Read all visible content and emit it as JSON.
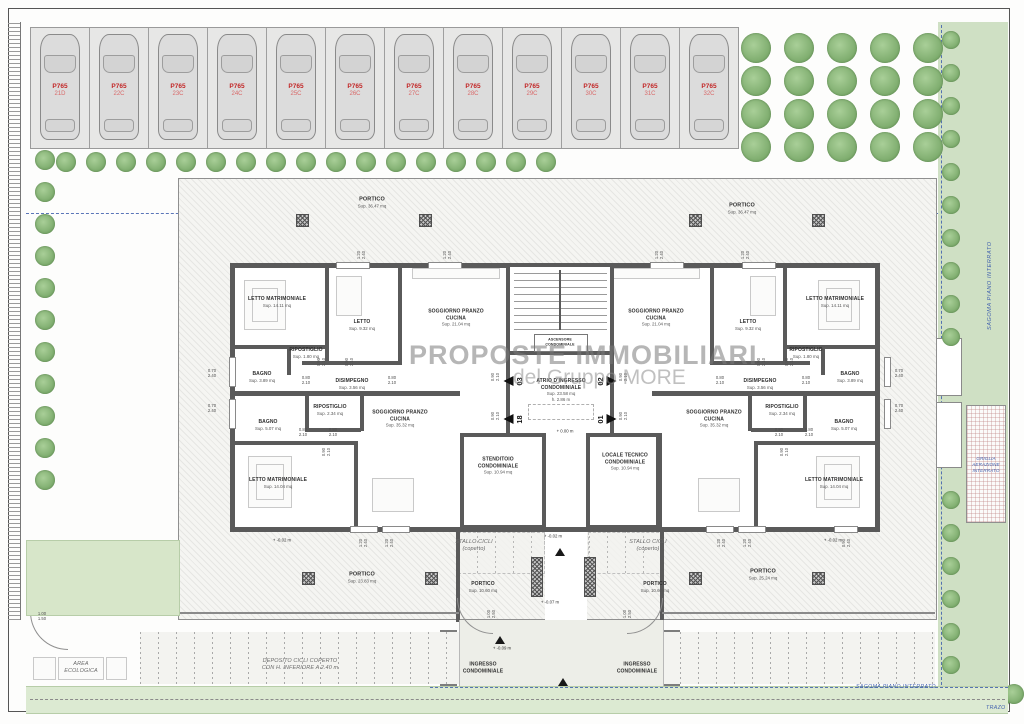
{
  "watermark": {
    "line1": "PROPOSTE IMMOBILIARI",
    "line2": "del Gruppo MORE"
  },
  "parking": {
    "code": "P765",
    "stalls": [
      "21D",
      "22C",
      "23C",
      "24C",
      "25C",
      "26C",
      "27C",
      "28C",
      "29C",
      "30C",
      "31C",
      "32C"
    ]
  },
  "site_labels": {
    "sagoma_right": "SAGOMA PIANO INTERRATO",
    "sagoma_bottom": "SAGOMA PIANO INTERRATO",
    "griglia": "GRIGLIA\nAERAZIONE\nINTERRATO",
    "trazo": "TRAZO"
  },
  "rooms": [
    {
      "n": "PORTICO",
      "s": "Sup. 36.47 mq",
      "x": 372,
      "y": 203,
      "st": "bigp"
    },
    {
      "n": "PORTICO",
      "s": "Sup. 36.47 mq",
      "x": 742,
      "y": 209,
      "st": "bigp"
    },
    {
      "n": "LETTO MATRIMONIALE",
      "s": "Sup. 14.11 mq",
      "x": 277,
      "y": 302
    },
    {
      "n": "LETTO",
      "s": "Sup. 9.32 mq",
      "x": 362,
      "y": 325
    },
    {
      "n": "SOGGIORNO PRANZO\nCUCINA",
      "s": "Sup. 21.04 mq",
      "x": 456,
      "y": 318
    },
    {
      "n": "RIPOSTIGLIO",
      "s": "Sup. 1.80 mq",
      "x": 306,
      "y": 353
    },
    {
      "n": "BAGNO",
      "s": "Sup. 3.89 mq",
      "x": 262,
      "y": 377
    },
    {
      "n": "DISIMPEGNO",
      "s": "Sup. 3.56 mq",
      "x": 352,
      "y": 384
    },
    {
      "n": "SOGGIORNO PRANZO\nCUCINA",
      "s": "Sup. 21.04 mq",
      "x": 656,
      "y": 318
    },
    {
      "n": "LETTO",
      "s": "Sup. 9.32 mq",
      "x": 748,
      "y": 325
    },
    {
      "n": "LETTO MATRIMONIALE",
      "s": "Sup. 14.11 mq",
      "x": 835,
      "y": 302
    },
    {
      "n": "RIPOSTIGLIO",
      "s": "Sup. 1.80 mq",
      "x": 806,
      "y": 353
    },
    {
      "n": "BAGNO",
      "s": "Sup. 3.89 mq",
      "x": 850,
      "y": 377
    },
    {
      "n": "DISIMPEGNO",
      "s": "Sup. 3.56 mq",
      "x": 760,
      "y": 384
    },
    {
      "n": "ATRIO D'INGRESSO\nCONDOMINIALE",
      "s": "Sup. 23.58 mq\nh. 2.86 m",
      "x": 561,
      "y": 390
    },
    {
      "n": "ASCENSORE\nCONDOMINIALE",
      "s": "",
      "x": 560,
      "y": 342,
      "st": "tiny"
    },
    {
      "n": "RIPOSTIGLIO",
      "s": "Sup. 2.34 mq",
      "x": 330,
      "y": 410
    },
    {
      "n": "BAGNO",
      "s": "Sup. 5.07 mq",
      "x": 268,
      "y": 425
    },
    {
      "n": "SOGGIORNO PRANZO\nCUCINA",
      "s": "Sup. 35.32 mq",
      "x": 400,
      "y": 419
    },
    {
      "n": "LETTO MATRIMONIALE",
      "s": "Sup. 14.04 mq",
      "x": 278,
      "y": 483
    },
    {
      "n": "RIPOSTIGLIO",
      "s": "Sup. 2.34 mq",
      "x": 782,
      "y": 410
    },
    {
      "n": "BAGNO",
      "s": "Sup. 5.07 mq",
      "x": 844,
      "y": 425
    },
    {
      "n": "SOGGIORNO PRANZO\nCUCINA",
      "s": "Sup. 35.32 mq",
      "x": 714,
      "y": 419
    },
    {
      "n": "LETTO MATRIMONIALE",
      "s": "Sup. 14.04 mq",
      "x": 834,
      "y": 483
    },
    {
      "n": "STENDITOIO\nCONDOMINIALE",
      "s": "Sup. 10.94 mq",
      "x": 498,
      "y": 466
    },
    {
      "n": "LOCALE TECNICO\nCONDOMINIALE",
      "s": "Sup. 10.94 mq",
      "x": 625,
      "y": 462
    },
    {
      "n": "STALLO CICLI\n(coperto)",
      "s": "",
      "x": 474,
      "y": 546,
      "st": "it"
    },
    {
      "n": "STALLO CICLI\n(coperto)",
      "s": "",
      "x": 648,
      "y": 546,
      "st": "it"
    },
    {
      "n": "PORTICO",
      "s": "Sup. 10.60 mq",
      "x": 483,
      "y": 587
    },
    {
      "n": "PORTICO",
      "s": "Sup. 10.60 mq",
      "x": 655,
      "y": 587
    },
    {
      "n": "PORTICO",
      "s": "Sup. 23.83 mq",
      "x": 362,
      "y": 578,
      "st": "bigp"
    },
    {
      "n": "PORTICO",
      "s": "Sup. 25.24 mq",
      "x": 763,
      "y": 575,
      "st": "bigp"
    },
    {
      "n": "INGRESSO\nCONDOMINIALE",
      "s": "",
      "x": 483,
      "y": 668
    },
    {
      "n": "INGRESSO\nCONDOMINIALE",
      "s": "",
      "x": 637,
      "y": 668
    },
    {
      "n": "AREA\nECOLOGICA",
      "s": "",
      "x": 81,
      "y": 668,
      "st": "it"
    },
    {
      "n": "DEPOSITO CICLI COPERTO\nCON H. INFERIORE A 2.40 m",
      "s": "",
      "x": 300,
      "y": 665,
      "st": "it"
    }
  ],
  "entrances": [
    {
      "num": "03",
      "x": 514,
      "y": 381,
      "side": "l"
    },
    {
      "num": "18",
      "x": 514,
      "y": 419,
      "side": "l"
    },
    {
      "num": "02",
      "x": 606,
      "y": 381,
      "side": "r"
    },
    {
      "num": "01",
      "x": 606,
      "y": 419,
      "side": "r"
    }
  ],
  "dimensions": [
    {
      "t": "1.20\n2.40",
      "x": 362,
      "y": 255,
      "v": true
    },
    {
      "t": "1.20\n2.40",
      "x": 448,
      "y": 255,
      "v": true
    },
    {
      "t": "1.20\n2.40",
      "x": 660,
      "y": 255,
      "v": true
    },
    {
      "t": "1.20\n2.40",
      "x": 746,
      "y": 255,
      "v": true
    },
    {
      "t": "0.70\n2.40",
      "x": 212,
      "y": 374
    },
    {
      "t": "0.70\n2.40",
      "x": 212,
      "y": 409
    },
    {
      "t": "0.70\n2.40",
      "x": 899,
      "y": 374
    },
    {
      "t": "0.70\n2.40",
      "x": 899,
      "y": 409
    },
    {
      "t": "0.90\n2.10",
      "x": 322,
      "y": 362,
      "v": true
    },
    {
      "t": "0.90\n2.10",
      "x": 350,
      "y": 362,
      "v": true
    },
    {
      "t": "0.90\n2.10",
      "x": 762,
      "y": 362,
      "v": true
    },
    {
      "t": "0.90\n2.10",
      "x": 790,
      "y": 362,
      "v": true
    },
    {
      "t": "0.80\n2.10",
      "x": 306,
      "y": 381
    },
    {
      "t": "0.80\n2.10",
      "x": 392,
      "y": 381
    },
    {
      "t": "0.80\n2.10",
      "x": 720,
      "y": 381
    },
    {
      "t": "0.80\n2.10",
      "x": 806,
      "y": 381
    },
    {
      "t": "0.80\n2.10",
      "x": 303,
      "y": 433
    },
    {
      "t": "0.80\n2.10",
      "x": 333,
      "y": 433
    },
    {
      "t": "0.80\n2.10",
      "x": 779,
      "y": 433
    },
    {
      "t": "0.80\n2.10",
      "x": 809,
      "y": 433
    },
    {
      "t": "0.90\n2.10",
      "x": 327,
      "y": 452,
      "v": true
    },
    {
      "t": "0.90\n2.10",
      "x": 785,
      "y": 452,
      "v": true
    },
    {
      "t": "0.90\n2.10",
      "x": 496,
      "y": 377,
      "v": true
    },
    {
      "t": "0.90\n2.10",
      "x": 624,
      "y": 377,
      "v": true
    },
    {
      "t": "0.90\n2.10",
      "x": 496,
      "y": 416,
      "v": true
    },
    {
      "t": "0.90\n2.10",
      "x": 624,
      "y": 416,
      "v": true
    },
    {
      "t": "1.20\n2.40",
      "x": 364,
      "y": 543,
      "v": true
    },
    {
      "t": "1.20\n2.40",
      "x": 390,
      "y": 543,
      "v": true
    },
    {
      "t": "1.20\n2.40",
      "x": 722,
      "y": 543,
      "v": true
    },
    {
      "t": "1.20\n2.40",
      "x": 748,
      "y": 543,
      "v": true
    },
    {
      "t": "0.90\n2.40",
      "x": 847,
      "y": 543,
      "v": true
    },
    {
      "t": "1.00\n2.50",
      "x": 492,
      "y": 614,
      "v": true
    },
    {
      "t": "1.00\n2.50",
      "x": 628,
      "y": 614,
      "v": true
    },
    {
      "t": "1.00\n1.50",
      "x": 42,
      "y": 617
    }
  ],
  "levels": [
    {
      "t": "0.00 m",
      "x": 565,
      "y": 431
    },
    {
      "t": "-0.02 m",
      "x": 282,
      "y": 540
    },
    {
      "t": "-0.02 m",
      "x": 833,
      "y": 540
    },
    {
      "t": "-0.02 m",
      "x": 553,
      "y": 536
    },
    {
      "t": "-0.07 m",
      "x": 550,
      "y": 602
    },
    {
      "t": "-0.09 m",
      "x": 502,
      "y": 648
    }
  ]
}
